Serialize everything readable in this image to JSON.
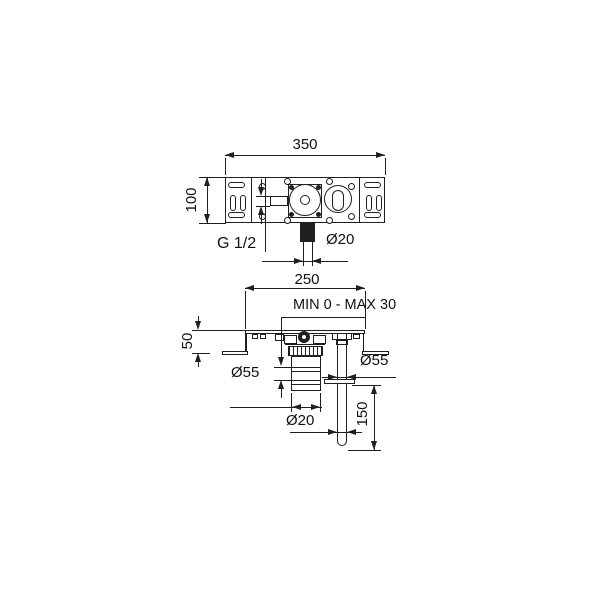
{
  "drawing_title": "concealed-mixer-installation-drawing",
  "colors": {
    "line": "#1f1f1f",
    "background": "#ffffff"
  },
  "top_view": {
    "dim_width": "350",
    "dim_height": "100",
    "thread_label": "G 1/2",
    "dim_pipe": "Ø20"
  },
  "bottom_view": {
    "dim_width": "250",
    "adjustment_label": "MIN 0 - MAX 30",
    "dim_depth": "50",
    "dim_body_diameter": "Ø55",
    "dim_flange_diameter": "Ø55",
    "dim_pipe_diameter": "Ø20",
    "dim_pipe_length": "150"
  }
}
